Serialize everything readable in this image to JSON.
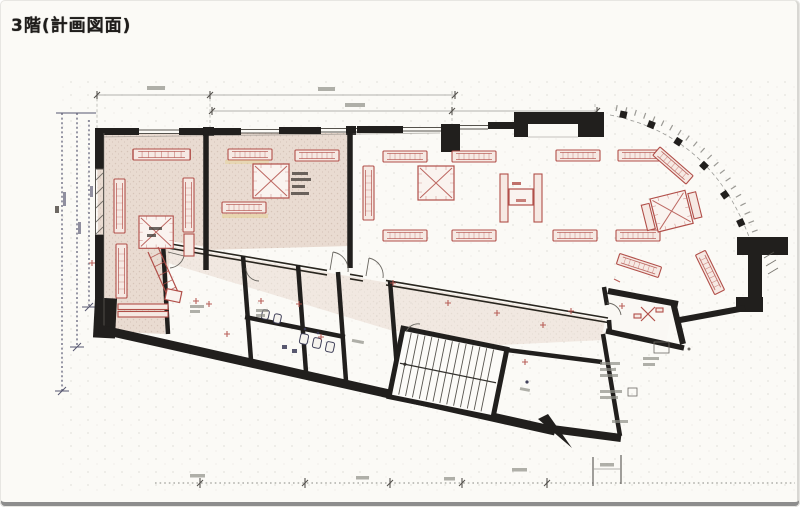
{
  "page": {
    "title": "3階(計画図面)"
  },
  "colors": {
    "paper": "#fbfaf6",
    "ink": "#1f1d1b",
    "wall": "#211f1d",
    "red": "#b14f49",
    "shade": "#e9dbd1",
    "dim": "#9b9b97",
    "chain": "#565670",
    "edge": "#8d8d8d"
  },
  "symbols": [
    "display-rack",
    "x-box-shaft",
    "escalator",
    "door-swing",
    "stair-hatch",
    "column",
    "toilet-fixture",
    "dimension-tick"
  ]
}
